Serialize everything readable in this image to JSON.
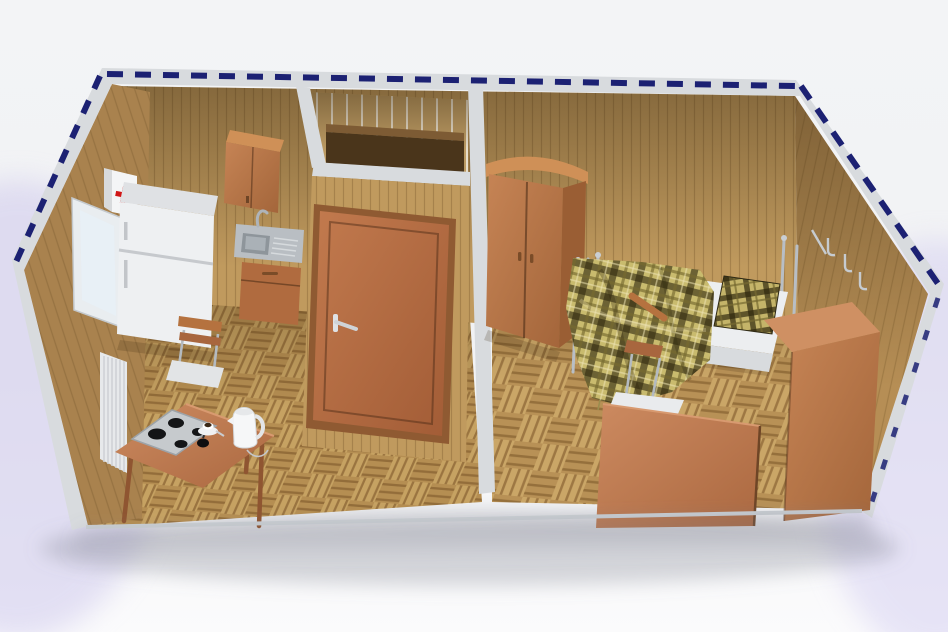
{
  "scene": {
    "type": "3d-render-cutaway-top-view",
    "subject": "modular container cabin interior with kitchen, bathroom and bedroom",
    "rooms": [
      {
        "name": "kitchen",
        "items": [
          "first-aid-cabinet",
          "refrigerator",
          "wall-cabinet",
          "sink-with-drainboard",
          "sink-base-cabinet",
          "window",
          "radiator",
          "dining-table",
          "portable-cooktop",
          "coffee-cup",
          "electric-kettle",
          "chair"
        ]
      },
      {
        "name": "bathroom",
        "items": [
          "wooden-door-with-handle",
          "dark-shower-enclosure"
        ]
      },
      {
        "name": "bedroom",
        "items": [
          "two-door-wardrobe",
          "single-bed-chrome-frame",
          "plaid-blanket",
          "plaid-pillow",
          "chair",
          "desk",
          "tall-cabinet",
          "chrome-wall-hooks"
        ]
      }
    ],
    "floor": "oak-parquet-basketweave",
    "walls": "wood-plank-paneling",
    "roof_edge": "navy-dashed-container-frame-marks"
  },
  "palette": {
    "bg_top": "#f4f5f7",
    "bg_bottom": "#fafafb",
    "lavender": "#cfc9ed",
    "cap_gray": "#d8dbde",
    "cap_gray_dark": "#c2c6ca",
    "navy": "#1c2173",
    "wall_interior": "#c09a5e",
    "wall_right": "#b68e55",
    "wall_exterior": "#a9824e",
    "wall_bathroom": "#bb9a63",
    "floor_base": "#bd965a",
    "furniture_wood": "#bf7d52",
    "door_wood": "#b5714b",
    "table_wood": "#a8663e",
    "dark_enclosure": "#4a351b",
    "appliance_white": "#eef0f2",
    "mattress_white": "#eceef0",
    "chrome": "#b8bec5",
    "steel": "#b9bec3",
    "plaid_base": "#c9bb6e",
    "plaid_dark": "#342c10",
    "red_cross": "#d01616",
    "glass_blue": "#dce8f2"
  }
}
